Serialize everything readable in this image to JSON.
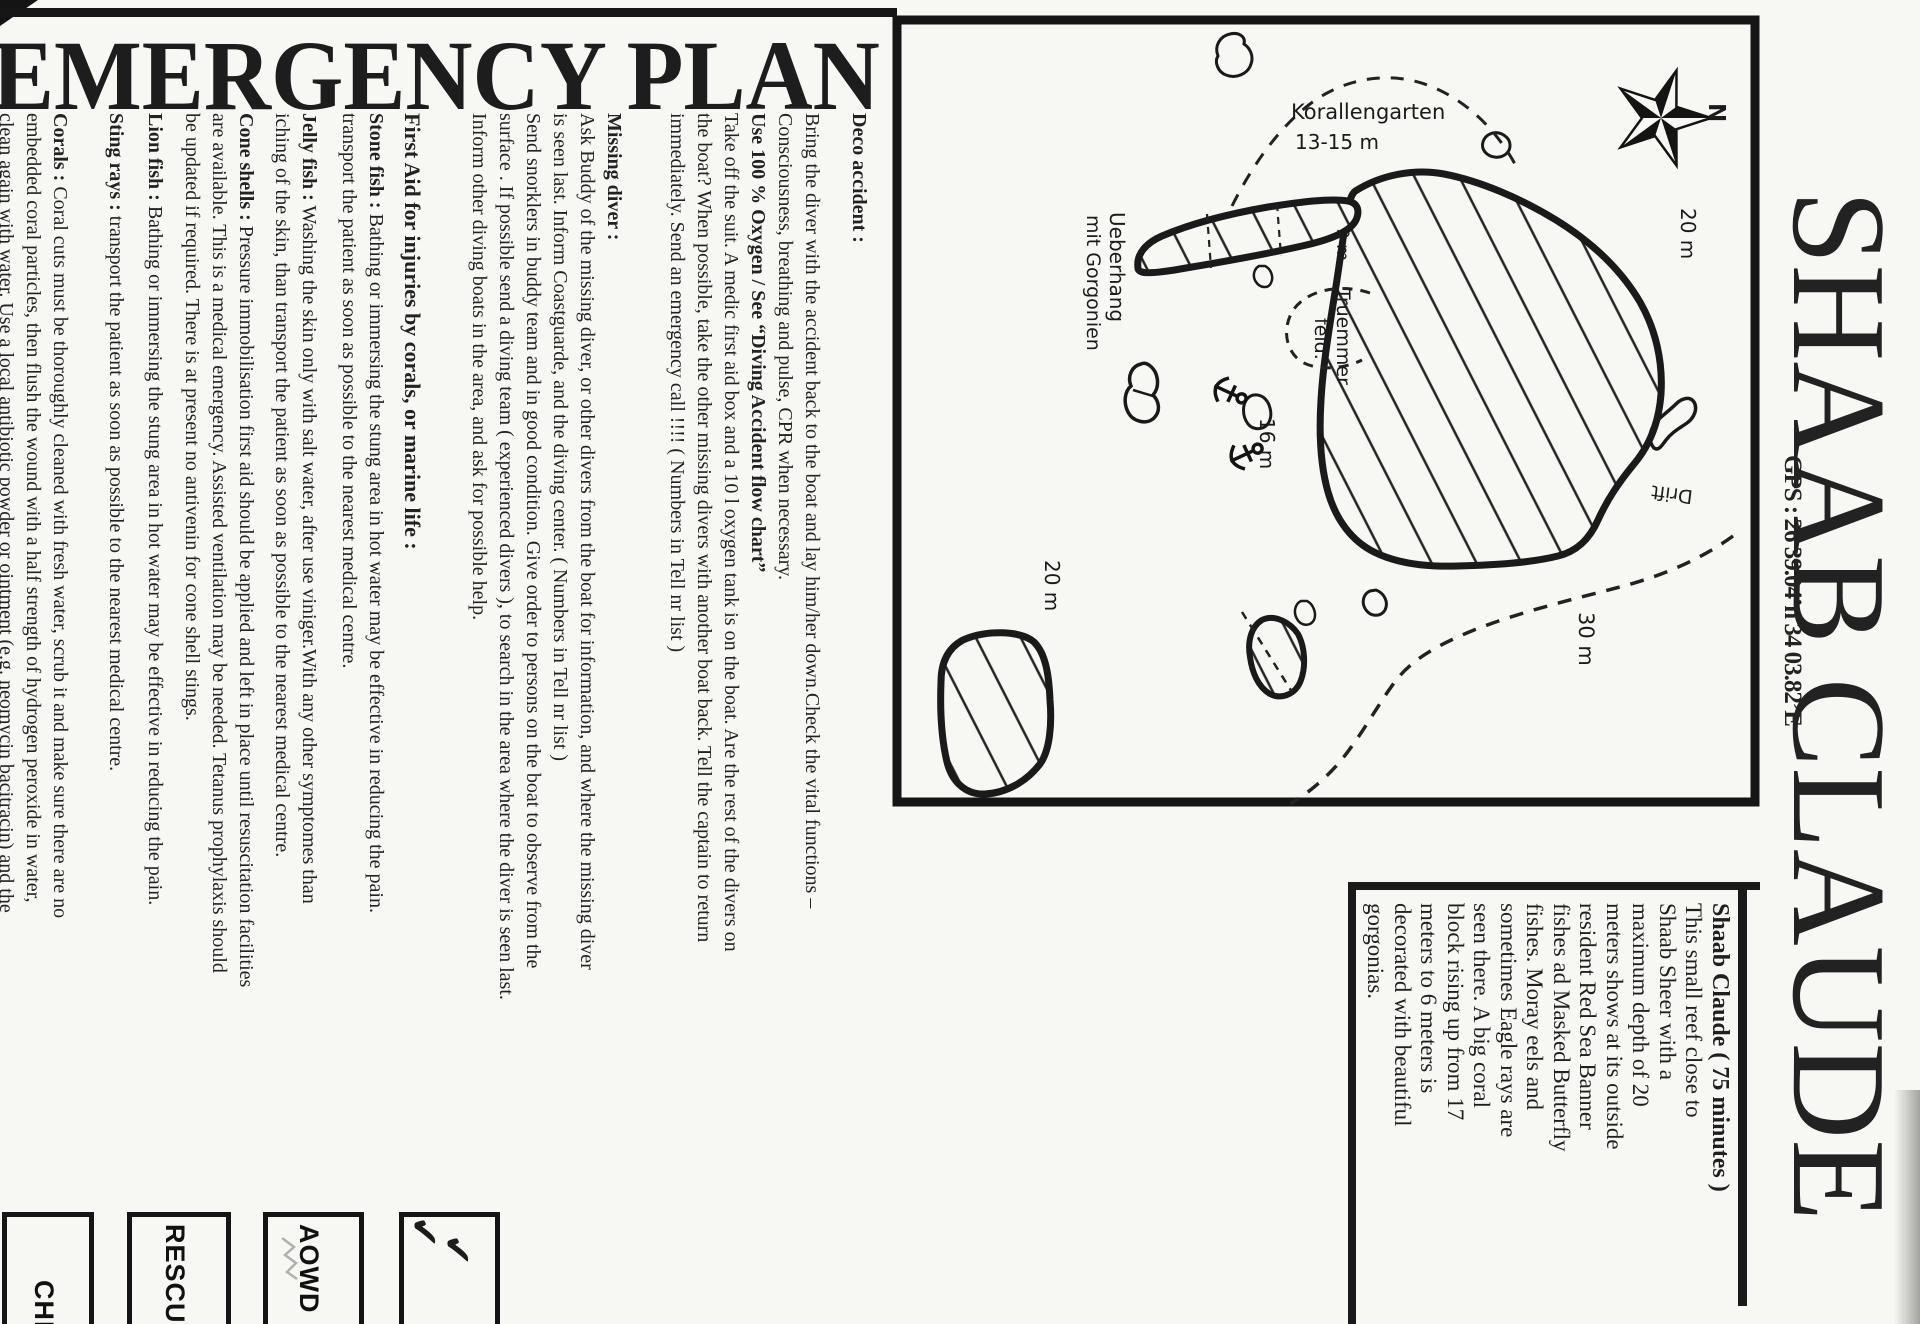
{
  "header": {
    "title": "EMERGENCY PLAN"
  },
  "site": {
    "title": "SHAAB CLAUDE",
    "gps": "GPS : 26 39.04’n 34 03.82’E"
  },
  "emergency": {
    "deco": {
      "heading": "Deco accident :",
      "body1": "Bring the diver with the accident back to the boat and lay him/her down.Check the vital functions –\nConsciousness, breathing and pulse, CPR when necessary.",
      "bold_line": "Use 100 % Oxygen / See “Diving Accident flow chart”",
      "body2": "Take off the suit. A medic first aid box and a 10 l oxygen tank is on the boat. Are the rest of the divers on\nthe boat? When possible, take the other missing divers with another boat back. Tell the captain to return\nimmediately. Send an emergency call !!!! ( Numbers in Tell nr list )"
    },
    "missing": {
      "heading": "Missing diver :",
      "body": "Ask Buddy of the missing diver, or other divers from the boat for information, and where the missing diver\nis seen last. Inform Coastguarde, and the diving center. ( Numbers in Tell nr list )\nSend snorklers in buddy team and in good condition. Give order to persons on the boat to observe from the\nsurface . If possible send a diving team ( experienced divers ), to search in the area where the diver is seen last.\nInform other diving boats in the area, and ask for possible help."
    },
    "first_aid": {
      "heading": "First Aid for injuries by corals, or marine life :",
      "items": [
        {
          "label": "Stone fish :",
          "text": " Bathing or immersing the stung area in hot water may be effective in reducing the pain.\ntransport the patient as soon as possible to the nearest medical centre."
        },
        {
          "label": "Jelly fish :",
          "text": " Washing the skin only with salt water, after use viniger.With any other symptomes than\niching of the skin, than transport the patient as soon as possible to the nearest medical centre."
        },
        {
          "label": "Cone shells :",
          "text": " Pressure immobilisation first aid should be applied and left in place until resuscitation facilities\nare available. This is a medical emergency. Assisted ventilation may be needed. Tetanus prophylaxis should\nbe updated if required. There is at present no antivenin for cone shell stings."
        },
        {
          "label": "Lion fish :",
          "text": " Bathing or immersing the stung area in hot water may be effective in reducing the pain."
        },
        {
          "label": "Sting rays :",
          "text": " transport the patient as soon as possible to the nearest medical centre."
        },
        {
          "label": "Corals :",
          "text": " Coral cuts must be thoroughly cleaned with fresh water, scrub it and make sure there are no\nembedded coral particles, then flush the wound with a half strength of hydrogen peroxide in water,\nclean again with water. Use a local antibiotic powder or ointment (e.g. neomycin bacitracin) and the"
        }
      ]
    }
  },
  "description": {
    "heading": "Shaab Claude ( 75 minutes )",
    "body": "This small reef close to\nShaab Sheer with a\nmaximum depth of 20\nmeters shows at its outside\nresident Red Sea Banner\nfishes ad Masked Butterfly\nfishes. Moray eels and\nsometimes Eagle rays are\nseen there. A big coral\nblock rising up from 17\nmeters to 6 meters is\ndecorated with beautiful\ngorgonias."
  },
  "map": {
    "labels": {
      "korallengarten": "Korallengarten",
      "koral_depth": "13-15 m",
      "depth_20_top": "20 m",
      "depth_9": "9 m",
      "ueberhang": "Ueberhang",
      "mit_gorgonien": "mit Gorgonien",
      "truemmer": "Truemmer",
      "feld": "feld.",
      "depth_16": "16 m",
      "depth_20_left": "20 m",
      "depth_30": "30 m",
      "drift": "Drift",
      "north": "N"
    }
  },
  "stamps": {
    "check": "CHECK",
    "rescue": "RESCUE",
    "aowd": "AOWD",
    "mark1": "✔",
    "mark2": "✔"
  }
}
